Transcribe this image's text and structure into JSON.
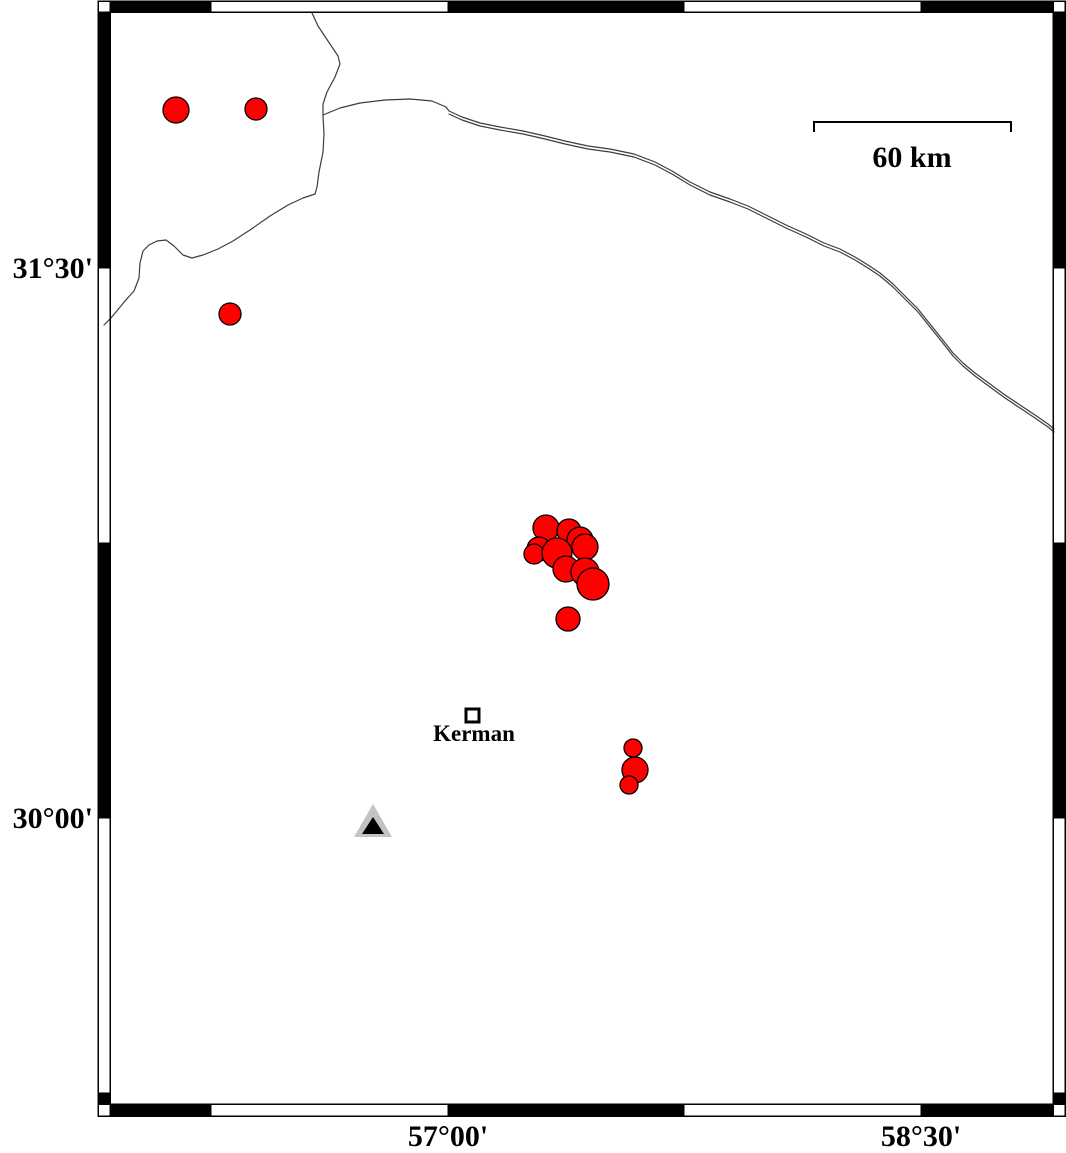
{
  "map": {
    "title": "Kerman region seismicity map",
    "axis": {
      "lat_ticks": [
        {
          "label": "31°30'",
          "x": 93,
          "y": 268
        },
        {
          "label": "30°00'",
          "x": 93,
          "y": 818
        }
      ],
      "lon_ticks": [
        {
          "label": "57°00'",
          "x": 448,
          "y": 1146
        },
        {
          "label": "58°30'",
          "x": 921,
          "y": 1146
        }
      ]
    },
    "scale_bar": {
      "label": "60 km",
      "x_start": 814,
      "x_end": 1011,
      "bar_y": 122,
      "tick_drop": 10,
      "label_x": 912,
      "label_y": 167
    },
    "city": {
      "name": "Kerman",
      "marker_x": 466,
      "marker_y": 709,
      "marker_size": 13,
      "label_x": 474,
      "label_y": 741
    },
    "station": {
      "outer_points": "373,804 354,837 392,837",
      "inner_points": "373,817 362,834 384,834"
    },
    "colors": {
      "epicenter": "#ff0000",
      "marker_outline": "#000000",
      "map_line": "#3d3d3d",
      "station_fill": "#c3c3c3",
      "station_inner": "#000000",
      "frame": "#000000"
    },
    "earthquakes": [
      {
        "x": 176,
        "y": 110,
        "r": 13
      },
      {
        "x": 256,
        "y": 109,
        "r": 11
      },
      {
        "x": 230,
        "y": 314,
        "r": 11
      },
      {
        "x": 546,
        "y": 528,
        "r": 13
      },
      {
        "x": 569,
        "y": 531,
        "r": 12
      },
      {
        "x": 580,
        "y": 540,
        "r": 13
      },
      {
        "x": 539,
        "y": 549,
        "r": 12
      },
      {
        "x": 534,
        "y": 554,
        "r": 10
      },
      {
        "x": 585,
        "y": 547,
        "r": 13
      },
      {
        "x": 557,
        "y": 553,
        "r": 15
      },
      {
        "x": 566,
        "y": 569,
        "r": 13
      },
      {
        "x": 585,
        "y": 572,
        "r": 14
      },
      {
        "x": 593,
        "y": 584,
        "r": 16
      },
      {
        "x": 568,
        "y": 619,
        "r": 12
      },
      {
        "x": 633,
        "y": 748,
        "r": 9
      },
      {
        "x": 635,
        "y": 770,
        "r": 13
      },
      {
        "x": 629,
        "y": 785,
        "r": 9
      }
    ],
    "map_lines": [
      {
        "name": "border-line",
        "points": "312,13 318,26 330,44 338,56 340,64 335,77 327,92 323,104 323,116 324,134 323,152 319,172 317,187 315,194 303,198 288,205 270,216 250,230 233,241 218,249 203,255 192,258 183,255 174,246 166,240 157,241 149,245 143,251 140,263 139,278 134,291 125,301 116,312 110,319 104,325"
      },
      {
        "name": "road-line-upper",
        "points": "323,115 340,108 360,103 385,100 410,99 432,101 446,107 449,111 462,117 480,123 500,127 523,131 545,136 565,141 588,146 610,149 634,154 655,162 672,171 690,182 710,192 730,199 748,206 766,215 786,225 806,234 824,243 840,249 855,257 868,265 880,273 893,284 906,297 918,309 930,324 942,339 953,353 963,363 975,373 990,384 1005,395 1020,405 1035,415 1048,424 1054,429"
      },
      {
        "name": "road-line-lower",
        "points": "449,114 462,120 480,126 500,130 523,134 545,139 565,144 588,149 610,152 634,157 655,165 672,174 690,185 710,195 730,202 748,209 766,218 786,228 806,237 824,246 840,252 855,260 868,268 880,276 893,287 906,300 918,312 930,327 942,342 953,356 963,366 975,376 990,387 1005,398 1020,408 1035,418 1048,427 1054,432"
      }
    ]
  }
}
